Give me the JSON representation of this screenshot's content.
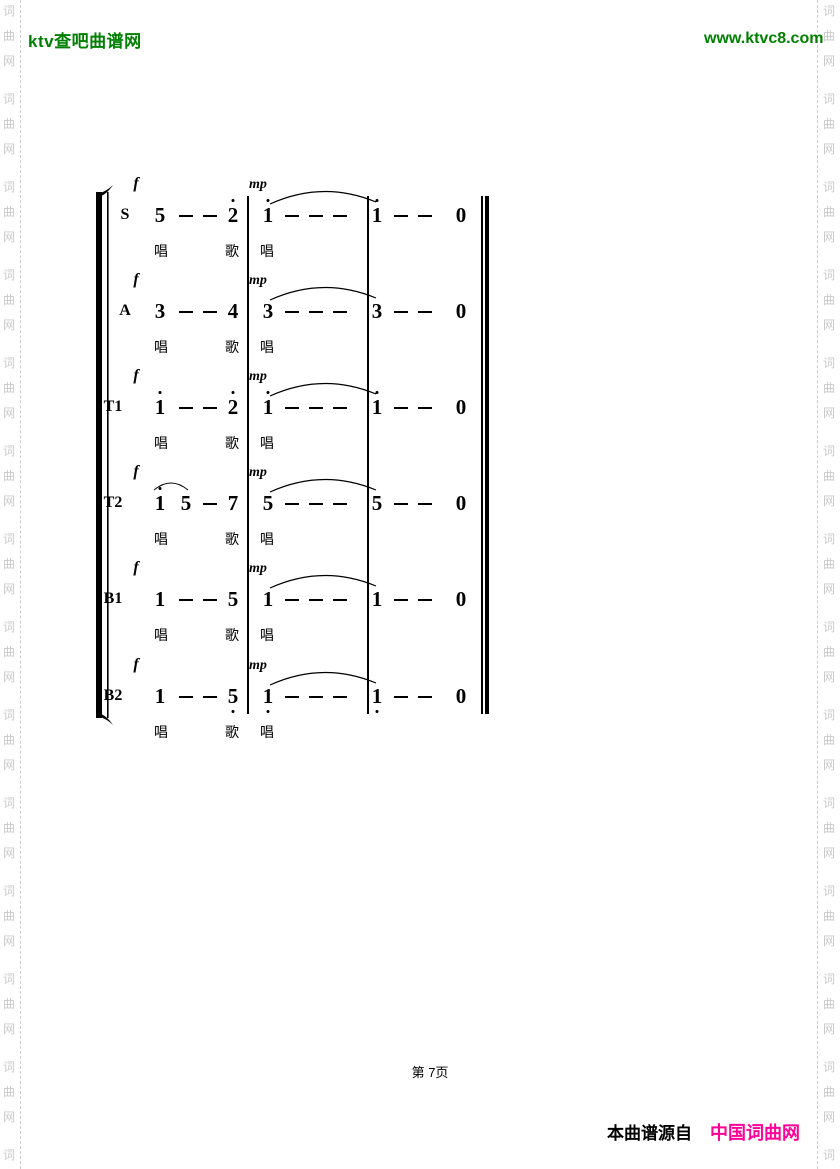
{
  "header": {
    "site_name": "ktv查吧曲谱网",
    "site_url": "www.ktvc8.com"
  },
  "watermark": {
    "text": "词曲网"
  },
  "score": {
    "dynamics": {
      "m1": "f",
      "m2": "mp"
    },
    "lyrics": [
      "唱",
      "歌",
      "唱"
    ],
    "parts": [
      {
        "label": "S",
        "measures": [
          [
            "5",
            "-",
            "-",
            "2*"
          ],
          [
            "1*",
            "-",
            "-",
            "-"
          ],
          [
            "1*",
            "-",
            "-",
            "0"
          ]
        ],
        "m1_slur": false
      },
      {
        "label": "A",
        "measures": [
          [
            "3",
            "-",
            "-",
            "4"
          ],
          [
            "3",
            "-",
            "-",
            "-"
          ],
          [
            "3",
            "-",
            "-",
            "0"
          ]
        ],
        "m1_slur": false
      },
      {
        "label": "T1",
        "measures": [
          [
            "1*",
            "-",
            "-",
            "2*"
          ],
          [
            "1*",
            "-",
            "-",
            "-"
          ],
          [
            "1*",
            "-",
            "-",
            "0"
          ]
        ],
        "m1_slur": false
      },
      {
        "label": "T2",
        "measures": [
          [
            "1*",
            "5",
            "-",
            "7"
          ],
          [
            "5",
            "-",
            "-",
            "-"
          ],
          [
            "5",
            "-",
            "-",
            "0"
          ]
        ],
        "m1_slur": true
      },
      {
        "label": "B1",
        "measures": [
          [
            "1",
            "-",
            "-",
            "5"
          ],
          [
            "1",
            "-",
            "-",
            "-"
          ],
          [
            "1",
            "-",
            "-",
            "0"
          ]
        ],
        "m1_slur": false
      },
      {
        "label": "B2",
        "measures": [
          [
            "1",
            "-",
            "-",
            "5."
          ],
          [
            "1.",
            "-",
            "-",
            "-"
          ],
          [
            "1.",
            "-",
            "-",
            "0"
          ]
        ],
        "m1_slur": false
      }
    ],
    "slur_m2_to_m3": true
  },
  "footer": {
    "page_label": "第 7页",
    "source_prefix": "本曲谱源自",
    "source_site": "中国词曲网"
  },
  "colors": {
    "brand_green": "#008000",
    "source_pink": "#ff0099",
    "watermark_gray": "#c9c9c9"
  }
}
